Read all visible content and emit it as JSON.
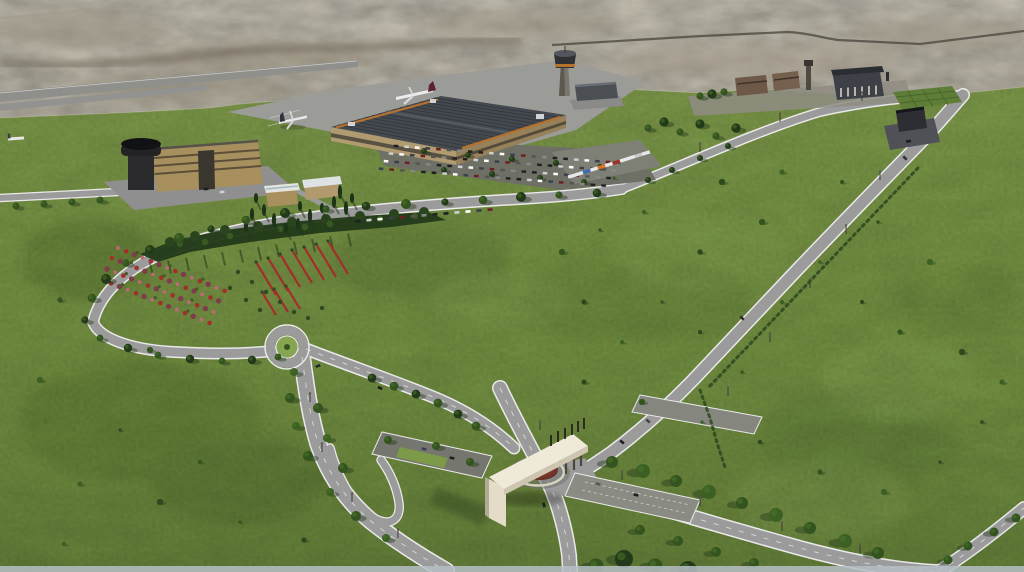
{
  "image": {
    "width": 1024,
    "height": 572,
    "kind": "3D aerial architectural rendering",
    "subject": "Airport campus masterplan: terminal, control tower, entrance gate monument, landscaped loop roads and lawns surrounded by desert terrain"
  },
  "scene": {
    "terrain": "Arid beige desert with a dark ridge and distant highway at the horizon",
    "grounds": "Large irrigated green lawns with scattered shrubs and tree-lined roads",
    "runway": "Runway and taxiways at upper left with parked aircraft on the apron",
    "terminal": "Passenger terminal with dark skylight roof and orange trim",
    "control_tower": "Air traffic control tower with dark cab and orange band",
    "admin_building": "Long administration building with dark cylindrical tower",
    "villas": "Two small flat-roofed buildings among conifer planting",
    "campus_buildings": "Support buildings, minaret tower and dark hangar along north edge",
    "substation": "Small dark utility building on paved pad near east road",
    "entrance_gate": "Monumental cream gateway slab with flag posts over a domed mini-roundabout",
    "roads": "Perimeter loop road, roundabout, divided boulevard and long diagonal access roads",
    "parking": "Car parking lot in front of terminal and diagonal truck parking row",
    "gardens": "Red and pink flower beds inside the landscape loop",
    "aircraft_visible": 3
  },
  "palette": {
    "desert_mid": "#b5ae9c",
    "desert_light": "#c8c2b1",
    "desert_dark": "#6f675a",
    "grass_main": "#7c9a47",
    "grass_dark": "#5e7a33",
    "grass_light": "#8cab57",
    "road_asphalt": "#9b9b9b",
    "road_edge": "#e9e9e9",
    "parking_asphalt": "#6e7066",
    "tree_dark": "#223a19",
    "tree_mid": "#33531f",
    "tree_light": "#4a7428",
    "flower_red": "#a1302a",
    "flower_pink": "#bb6a78",
    "terminal_roof": "#44494f",
    "terminal_trim": "#b5722f",
    "building_tan": "#ac9468",
    "gate_cream": "#efe9d9",
    "gate_dome": "#77302a",
    "tower_dark": "#2e3033",
    "aircraft_white": "#e9e9ec",
    "bottom_strip": "#b6bfc5"
  }
}
